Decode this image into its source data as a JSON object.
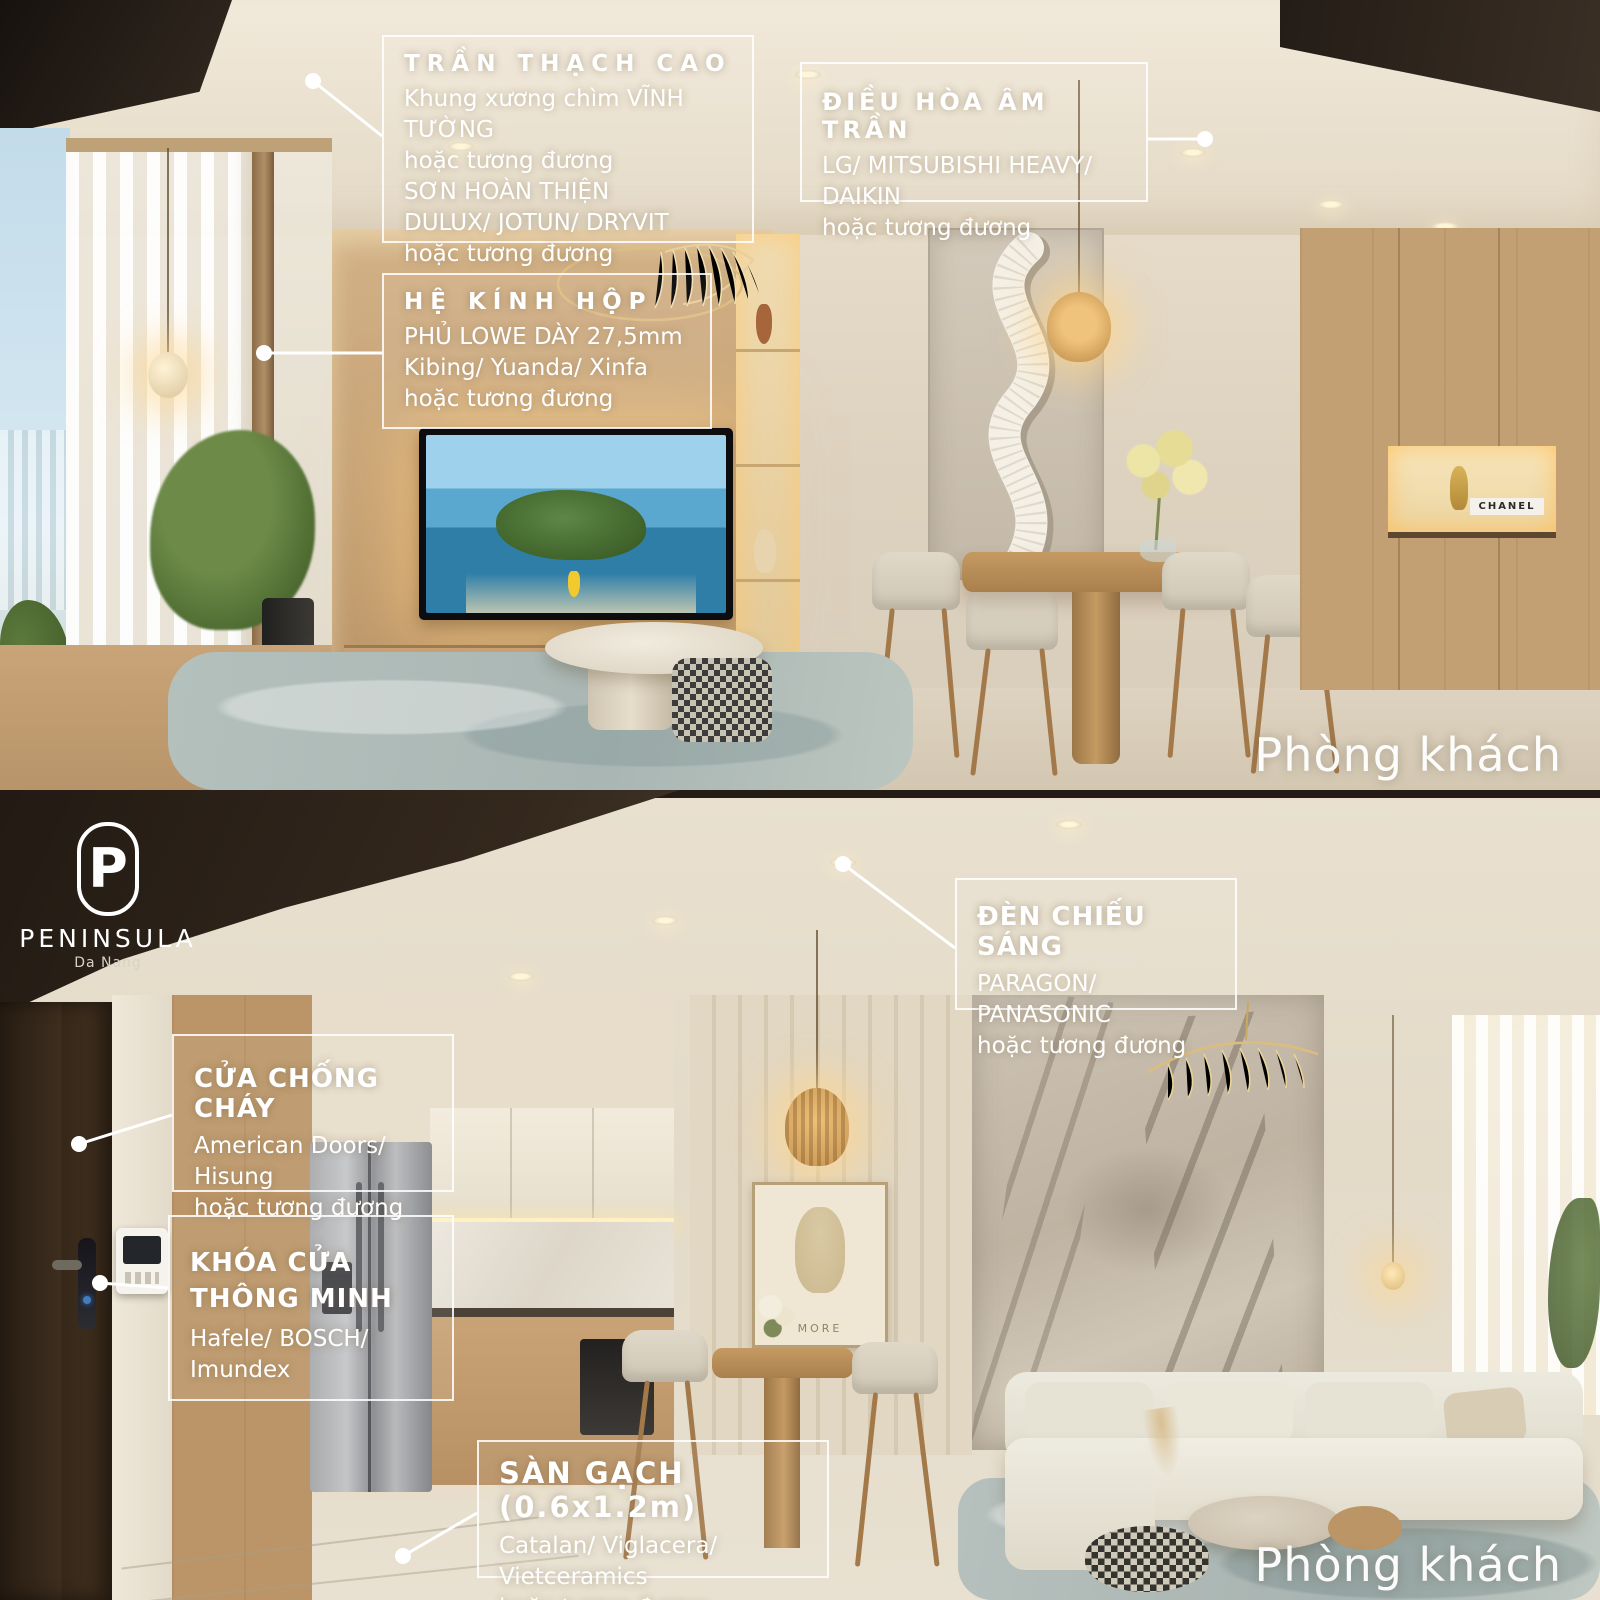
{
  "brand": {
    "logo_monogram": "P",
    "name": "PENINSULA",
    "location": "Da Nang"
  },
  "colors": {
    "callout_border": "#ffffff",
    "callout_text": "#ffffff",
    "room_label": "#ffffff",
    "leader_line": "#ffffff"
  },
  "decor": {
    "artwork_text": "MORE",
    "book_label": "CHANEL"
  },
  "panels": [
    {
      "room_label": "Phòng khách",
      "callouts": [
        {
          "title": "TRẦN THẠCH CAO",
          "lines": [
            "Khung xương chìm VĨNH TƯỜNG",
            "hoặc tương đương",
            "SƠN HOÀN THIỆN",
            "DULUX/ JOTUN/ DRYVIT",
            "hoặc tương đương"
          ]
        },
        {
          "title": "ĐIỀU HÒA ÂM TRẦN",
          "lines": [
            "LG/ MITSUBISHI HEAVY/ DAIKIN",
            "hoặc tương đương"
          ]
        },
        {
          "title": "HỆ KÍNH HỘP",
          "lines": [
            "PHỦ LOWE DÀY 27,5mm",
            "Kibing/ Yuanda/ Xinfa",
            "hoặc tương đương"
          ]
        }
      ]
    },
    {
      "room_label": "Phòng khách",
      "callouts": [
        {
          "title": "ĐÈN CHIẾU SÁNG",
          "lines": [
            "PARAGON/ PANASONIC",
            "hoặc tương đương"
          ]
        },
        {
          "title": "CỬA CHỐNG CHÁY",
          "lines": [
            "American Doors/ Hisung",
            "hoặc tương đương"
          ]
        },
        {
          "title": "KHÓA CỬA THÔNG MINH",
          "lines": [
            "Hafele/ BOSCH/ Imundex"
          ]
        },
        {
          "title": "SÀN GẠCH (0.6x1.2m)",
          "lines": [
            "Catalan/ Viglacera/ Vietceramics",
            "hoặc tương đương"
          ]
        }
      ]
    }
  ]
}
